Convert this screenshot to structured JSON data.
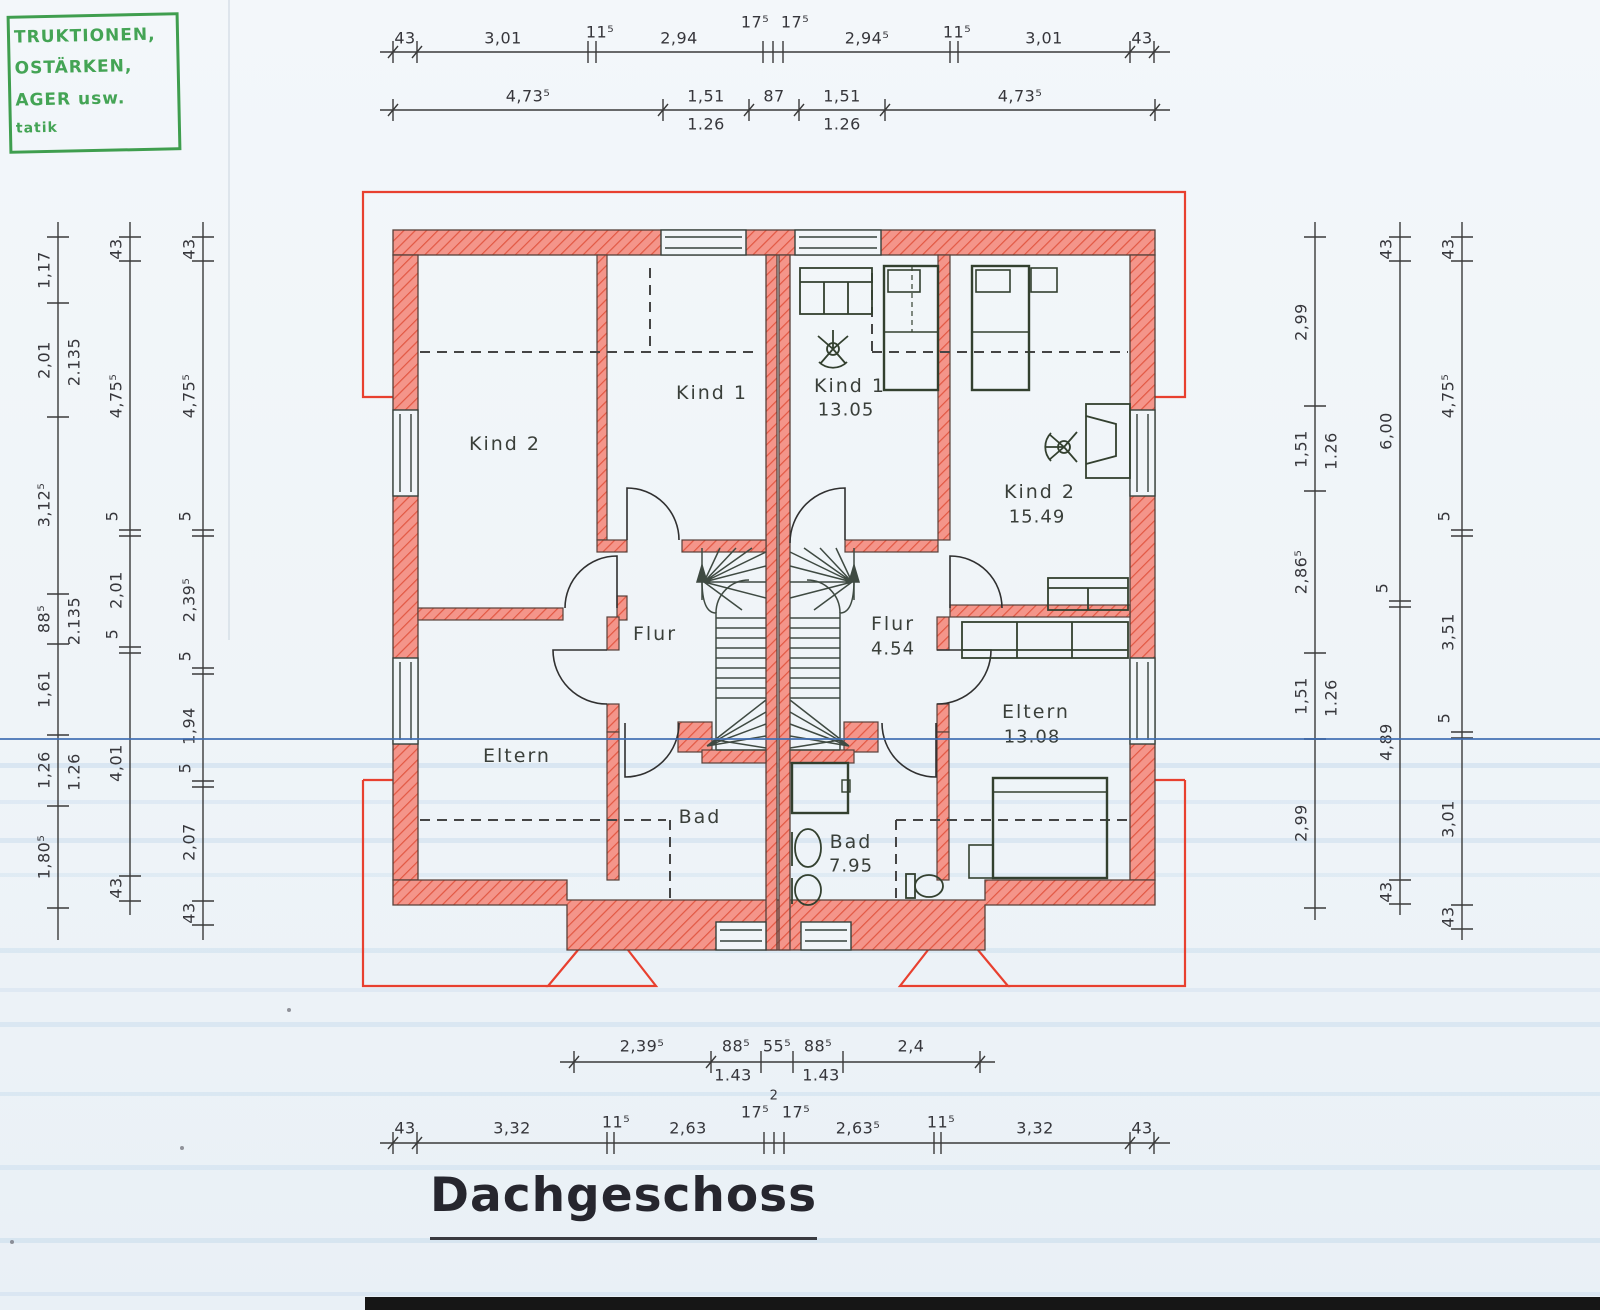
{
  "title": "Dachgeschoss",
  "stamp": {
    "lines": [
      "TRUKTIONEN,",
      "OSTÄRKEN,",
      "AGER usw.",
      "tatik"
    ]
  },
  "rooms": {
    "left": {
      "kind2": "Kind 2",
      "kind1": "Kind 1",
      "flur": "Flur",
      "eltern": "Eltern",
      "bad": "Bad"
    },
    "right": {
      "kind1": "Kind 1",
      "kind1_area": "13.05",
      "kind2": "Kind 2",
      "kind2_area": "15.49",
      "flur": "Flur",
      "flur_area": "4.54",
      "eltern": "Eltern",
      "eltern_area": "13.08",
      "bad": "Bad",
      "bad_area": "7.95"
    }
  },
  "dims": {
    "t1": [
      "43",
      "3,01",
      "11⁵",
      "2,94",
      "17⁵",
      "17⁵",
      "2,94⁵",
      "11⁵",
      "3,01",
      "43"
    ],
    "t2": {
      "top": [
        "4,73⁵",
        "1,51",
        "87",
        "1,51",
        "4,73⁵"
      ],
      "bot": [
        "1.26",
        "1.26"
      ]
    },
    "b1": {
      "top": [
        "2,39⁵",
        "88⁵",
        "55⁵",
        "88⁵",
        "2,4"
      ],
      "bot": [
        "1.43",
        "1.43"
      ]
    },
    "b2": [
      "43",
      "3,32",
      "11⁵",
      "2,63",
      "17⁵",
      "17⁵",
      "2,63⁵",
      "11⁵",
      "3,32",
      "43"
    ],
    "b2_note": "2",
    "l1": {
      "main": [
        "1,17",
        "2,01",
        "3,12⁵",
        "88⁵",
        "1,61",
        "1,26",
        "1,80⁵"
      ],
      "sub": [
        "2.135",
        "2.135",
        "1.26"
      ]
    },
    "l2": [
      "43",
      "4,75⁵",
      "5",
      "2,01",
      "5",
      "4,01",
      "43"
    ],
    "l3": [
      "43",
      "4,75⁵",
      "5",
      "2,39⁵",
      "5",
      "1,94",
      "5",
      "2,07",
      "43"
    ],
    "r1": {
      "main": [
        "2,99",
        "1,51",
        "2,86⁵",
        "1,51",
        "2,99"
      ],
      "sub": [
        "1.26",
        "1.26"
      ]
    },
    "r2": [
      "43",
      "6,00",
      "5",
      "4,89",
      "43"
    ],
    "r3": [
      "43",
      "4,75⁵",
      "5",
      "3,51",
      "5",
      "3,01",
      "43"
    ]
  },
  "colors": {
    "wall_fill": "#f4958a",
    "wall_hatch": "#e25742",
    "eaves_red": "#e8402f",
    "stamp_green": "#43a253",
    "scan_blue": "#3f6db3"
  }
}
